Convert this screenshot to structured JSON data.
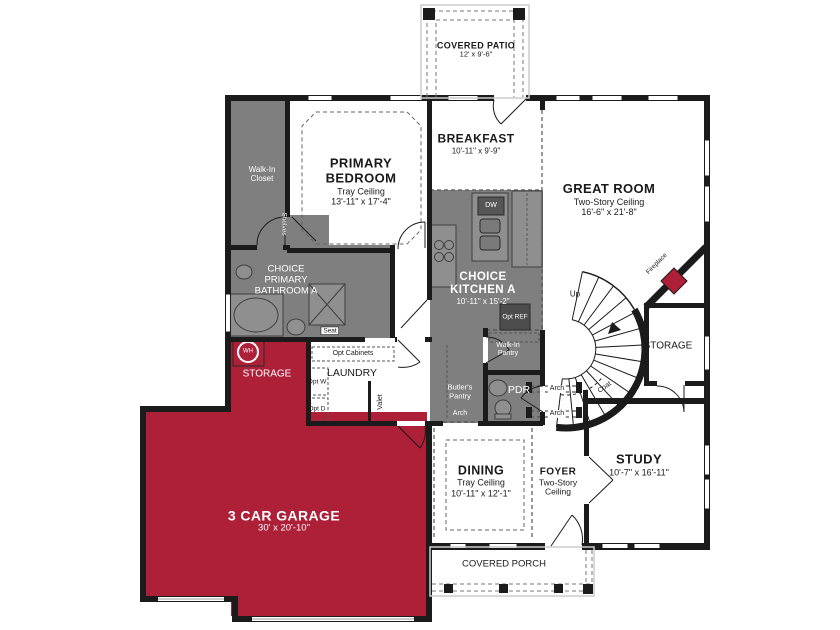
{
  "colors": {
    "accent_red": "#AE1F38",
    "room_gray": "#7F7F7F",
    "wall_black": "#1B1B1B",
    "background": "#FFFFFF"
  },
  "rooms": {
    "covered_patio": {
      "name": "COVERED PATIO",
      "dims": "12' x 9'-6\""
    },
    "primary_bedroom": {
      "name": "PRIMARY BEDROOM",
      "ceiling": "Tray Ceiling",
      "dims": "13'-11\" x 17'-4\""
    },
    "walk_in_closet": {
      "name": "Walk-In Closet",
      "shelves_label": "Shelves"
    },
    "breakfast": {
      "name": "BREAKFAST",
      "dims": "10'-11\" x 9'-9\""
    },
    "great_room": {
      "name": "GREAT ROOM",
      "ceiling": "Two-Story Ceiling",
      "dims": "16'-6\" x 21'-8\""
    },
    "primary_bathroom": {
      "name": "CHOICE PRIMARY BATHROOM A",
      "seat_label": "Seat"
    },
    "kitchen": {
      "name": "CHOICE KITCHEN A",
      "dims": "10'-11\" x 15'-2\"",
      "dw_label": "DW",
      "opt_ref_label": "Opt REF"
    },
    "storage_left": {
      "name": "STORAGE",
      "wh_label": "WH"
    },
    "laundry": {
      "name": "LAUNDRY",
      "opt_cabinets_label": "Opt Cabinets",
      "opt_washer_label": "Opt W",
      "opt_dryer_label": "Opt D",
      "valet_label": "Valet"
    },
    "butlers_pantry": {
      "name": "Butler's Pantry",
      "arch_label": "Arch"
    },
    "walk_in_pantry": {
      "name": "Walk-In Pantry"
    },
    "powder_room": {
      "name": "PDR"
    },
    "stairs": {
      "up_label": "Up",
      "coat_label": "Coat"
    },
    "fireplace": {
      "name": "Fireplace"
    },
    "storage_right": {
      "name": "STORAGE"
    },
    "foyer": {
      "name": "FOYER",
      "ceiling": "Two-Story Ceiling",
      "arch_upper_label": "Arch",
      "arch_lower_label": "Arch"
    },
    "dining": {
      "name": "DINING",
      "ceiling": "Tray Ceiling",
      "dims": "10'-11\" x 12'-1\""
    },
    "study": {
      "name": "STUDY",
      "dims": "10'-7\" x 16'-11\""
    },
    "garage": {
      "name": "3 CAR GARAGE",
      "dims": "30' x 20'-10\""
    },
    "covered_porch": {
      "name": "COVERED PORCH"
    }
  }
}
